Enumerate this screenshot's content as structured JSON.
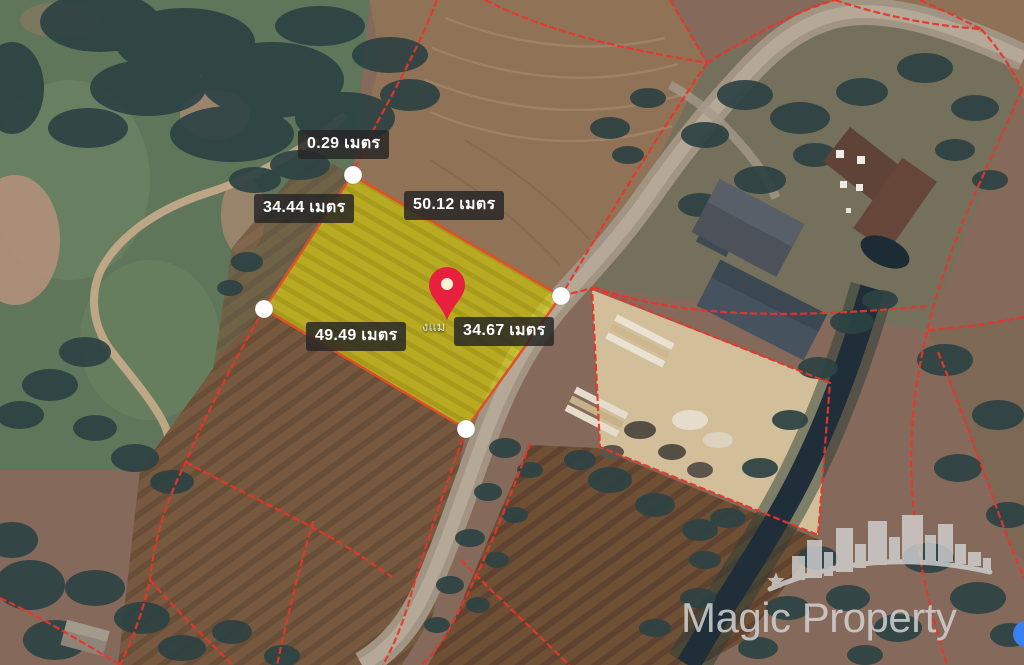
{
  "map_overlay": {
    "measurements": [
      {
        "name": "segment-top",
        "value": "0.29",
        "unit": "เมตร",
        "text": "0.29 เมตร"
      },
      {
        "name": "edge-northwest",
        "value": "34.44",
        "unit": "เมตร",
        "text": "34.44 เมตร"
      },
      {
        "name": "edge-northeast",
        "value": "50.12",
        "unit": "เมตร",
        "text": "50.12 เมตร"
      },
      {
        "name": "edge-southwest",
        "value": "49.49",
        "unit": "เมตร",
        "text": "49.49 เมตร"
      },
      {
        "name": "edge-southeast",
        "value": "34.67",
        "unit": "เมตร",
        "text": "34.67 เมตร"
      }
    ],
    "place_label_fragment": "งแม",
    "marker": "red-location-pin",
    "highlighted_plot_vertices": 4
  },
  "watermark": {
    "brand": "Magic Property"
  },
  "colors": {
    "parcel_boundary_red": "#e8352a",
    "plot_highlight_yellow": "#d8d202",
    "plot_outline_orange": "#df4f28",
    "pin_red": "#e8203e",
    "vertex_dot_white": "#ffffff",
    "label_background": "rgba(38,38,38,0.84)",
    "label_text": "#ffffff",
    "watermark_gray": "#d2d2d2",
    "blue_dot": "#3b7ff0",
    "canal_water": "#1f2e38",
    "road_gray": "#a29483"
  }
}
